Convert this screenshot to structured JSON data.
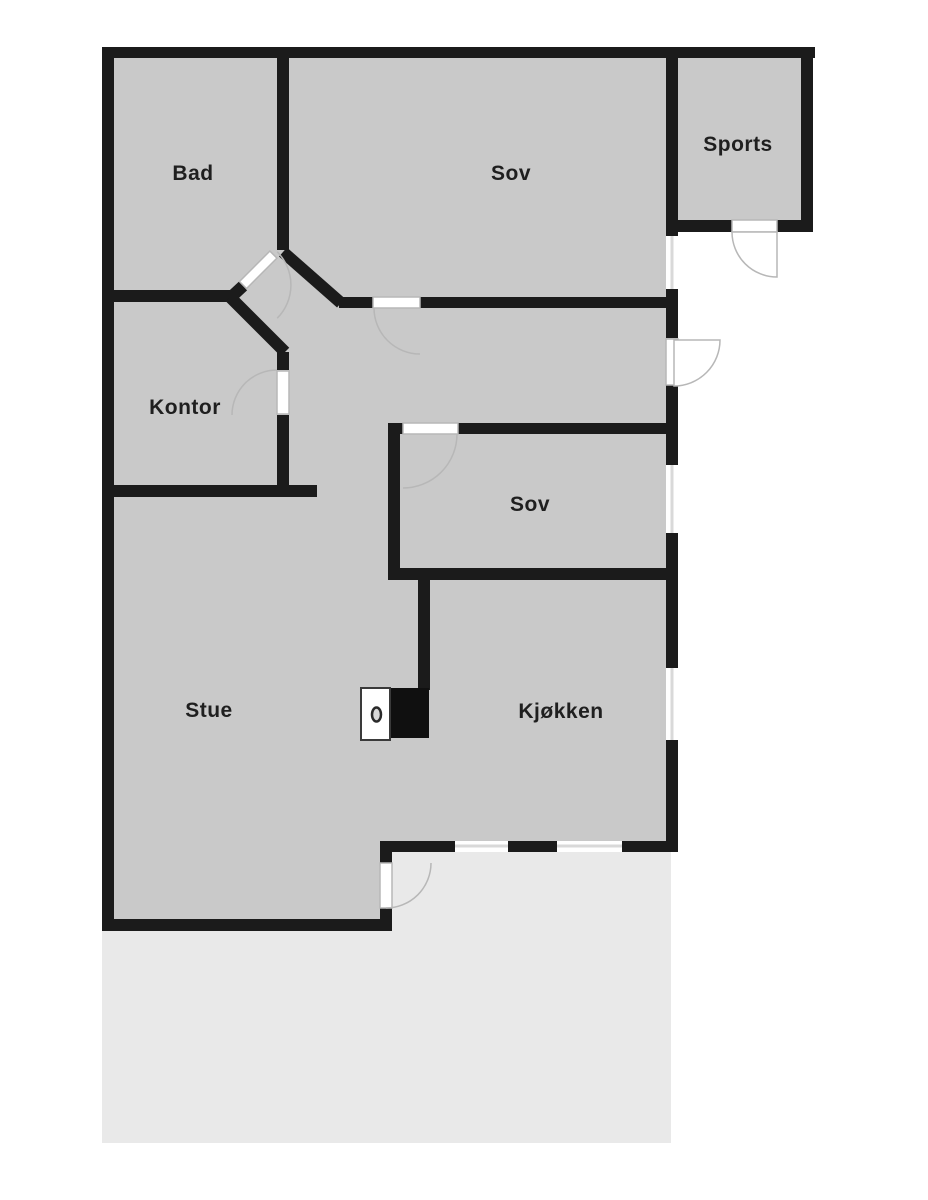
{
  "title": "Floor plan",
  "colors": {
    "wall": "#1b1b1b",
    "room_fill": "#c9c9c9",
    "terrace_fill": "#e9e9e9",
    "door_stroke": "#b7b7b7",
    "window_line": "#d9d9d9",
    "label": "#1f1f1f"
  },
  "rooms": [
    {
      "id": "bad",
      "label": "Bad"
    },
    {
      "id": "sov1",
      "label": "Sov"
    },
    {
      "id": "sports",
      "label": "Sports"
    },
    {
      "id": "kontor",
      "label": "Kontor"
    },
    {
      "id": "sov2",
      "label": "Sov"
    },
    {
      "id": "stue",
      "label": "Stue"
    },
    {
      "id": "kjokken",
      "label": "Kjøkken"
    }
  ],
  "symbols": [
    {
      "id": "stove",
      "name": "fireplace-stove-symbol"
    }
  ],
  "areas": [
    {
      "id": "terrace",
      "label": ""
    }
  ]
}
